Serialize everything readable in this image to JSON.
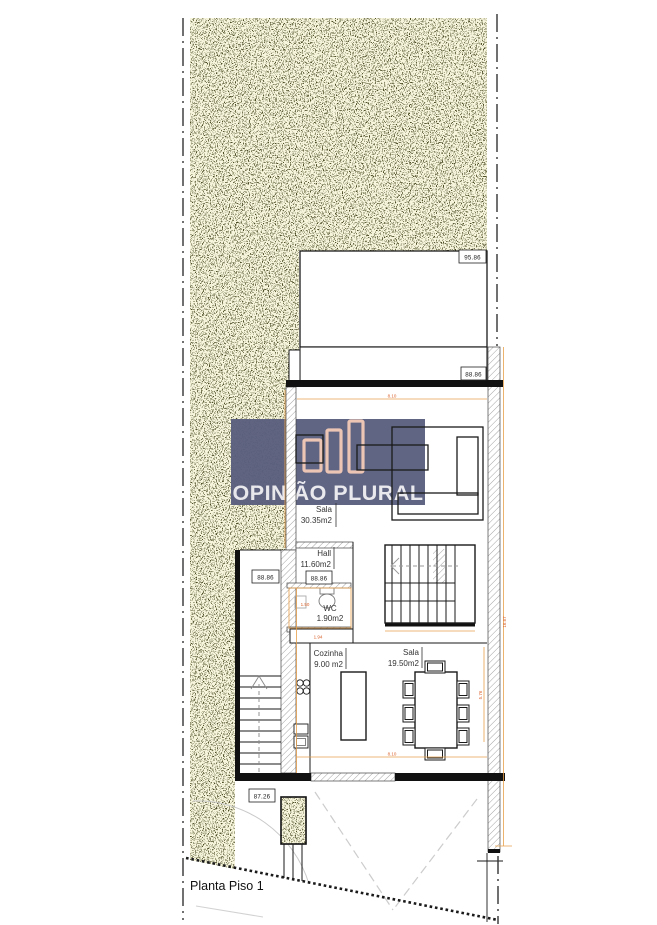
{
  "drawing": {
    "title": "Planta Piso 1"
  },
  "watermark": {
    "prefix": "OPIN",
    "accent_letter": "I",
    "suffix": "ÃO PLURAL",
    "bg_color": "#5a5f7e",
    "bar_color": "#ecc3b2",
    "text_color": "#e9e9ee",
    "accent_color": "#cc4433"
  },
  "elevation_markers": {
    "terrain_top": "95.86",
    "terrace": "88.86",
    "hall": "88.86",
    "exterior_stair": "88.86",
    "street_level": "87.26"
  },
  "rooms": {
    "living": {
      "name": "Sala",
      "area": "30.35m2"
    },
    "hall": {
      "name": "Hall",
      "area": "11.60m2"
    },
    "wc": {
      "name": "WC",
      "area": "1.90m2"
    },
    "kitchen": {
      "name": "Cozinha",
      "area": "9.00 m2"
    },
    "dining": {
      "name": "Sala",
      "area": "19.50m2"
    }
  },
  "dimensions": {
    "living_width": "8.10",
    "dining_width": "8.10",
    "site_depth": "16.67",
    "dining_depth": "5.76",
    "wc_width": "1.50",
    "wc_depth": "1.94"
  },
  "palette": {
    "terrain_bg": "#f7f6dc",
    "terrain_dot": "#4d4d28",
    "wall_accent": "#e8a04b",
    "dim_text": "#d95f28"
  }
}
